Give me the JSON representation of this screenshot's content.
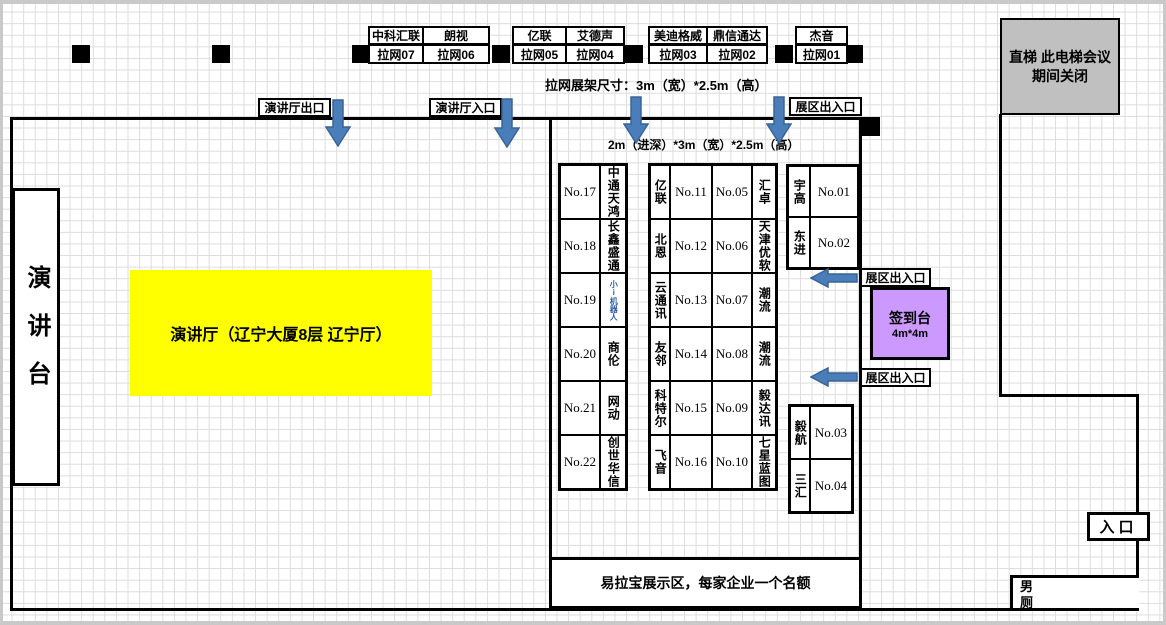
{
  "colors": {
    "arrow_blue": "#4a7ebb",
    "hall_yellow": "#ffff00",
    "signin_purple": "#cc99ff",
    "elevator_gray": "#c0c0c0"
  },
  "top_stands": [
    {
      "company": "中科汇联",
      "stand": "拉网07"
    },
    {
      "company": "朗视",
      "stand": "拉网06"
    },
    {
      "company": "亿联",
      "stand": "拉网05"
    },
    {
      "company": "艾德声",
      "stand": "拉网04"
    },
    {
      "company": "美迪格威",
      "stand": "拉网03"
    },
    {
      "company": "鼎信通达",
      "stand": "拉网02"
    },
    {
      "company": "杰音",
      "stand": "拉网01"
    }
  ],
  "notes": {
    "rack_size": "拉网展架尺寸：3m（宽）*2.5m（高）",
    "booth_size": "2m（进深）*3m（宽）*2.5m（高）"
  },
  "doors": {
    "hall_exit": "演讲厅出口",
    "hall_entrance": "演讲厅入口",
    "expo_gate_top": "展区出入口",
    "expo_gate_mid": "展区出入口",
    "expo_gate_low": "展区出入口",
    "entrance": "入口"
  },
  "rooms": {
    "stage": "演讲台",
    "hall": "演讲厅（辽宁大厦8层  辽宁厅）",
    "elevator": "直梯 此电梯会议期间关闭",
    "mens_room": "男厕",
    "banner_area": "易拉宝展示区，每家企业一个名额",
    "signin": {
      "label": "签到台",
      "size": "4m*4m"
    }
  },
  "booths": {
    "left": [
      {
        "no": "No.17",
        "company": "中通天鸿"
      },
      {
        "no": "No.18",
        "company": "长鑫盛通"
      },
      {
        "no": "No.19",
        "company": "小i机器人"
      },
      {
        "no": "No.20",
        "company": "商伦"
      },
      {
        "no": "No.21",
        "company": "网动"
      },
      {
        "no": "No.22",
        "company": "创世华信"
      }
    ],
    "middle": [
      {
        "company_left": "亿联",
        "no_left": "No.11",
        "no_right": "No.05",
        "company_right": "汇卓"
      },
      {
        "company_left": "北恩",
        "no_left": "No.12",
        "no_right": "No.06",
        "company_right": "天津优软"
      },
      {
        "company_left": "云通讯",
        "no_left": "No.13",
        "no_right": "No.07",
        "company_right": "潮流"
      },
      {
        "company_left": "友邻",
        "no_left": "No.14",
        "no_right": "No.08",
        "company_right": "潮流"
      },
      {
        "company_left": "科特尔",
        "no_left": "No.15",
        "no_right": "No.09",
        "company_right": "毅达讯"
      },
      {
        "company_left": "飞音",
        "no_left": "No.16",
        "no_right": "No.10",
        "company_right": "七星蓝图"
      }
    ],
    "right_top": [
      {
        "company": "宇高",
        "no": "No.01"
      },
      {
        "company": "东进",
        "no": "No.02"
      }
    ],
    "right_bottom": [
      {
        "company": "毅航",
        "no": "No.03"
      },
      {
        "company": "三汇",
        "no": "No.04"
      }
    ]
  }
}
